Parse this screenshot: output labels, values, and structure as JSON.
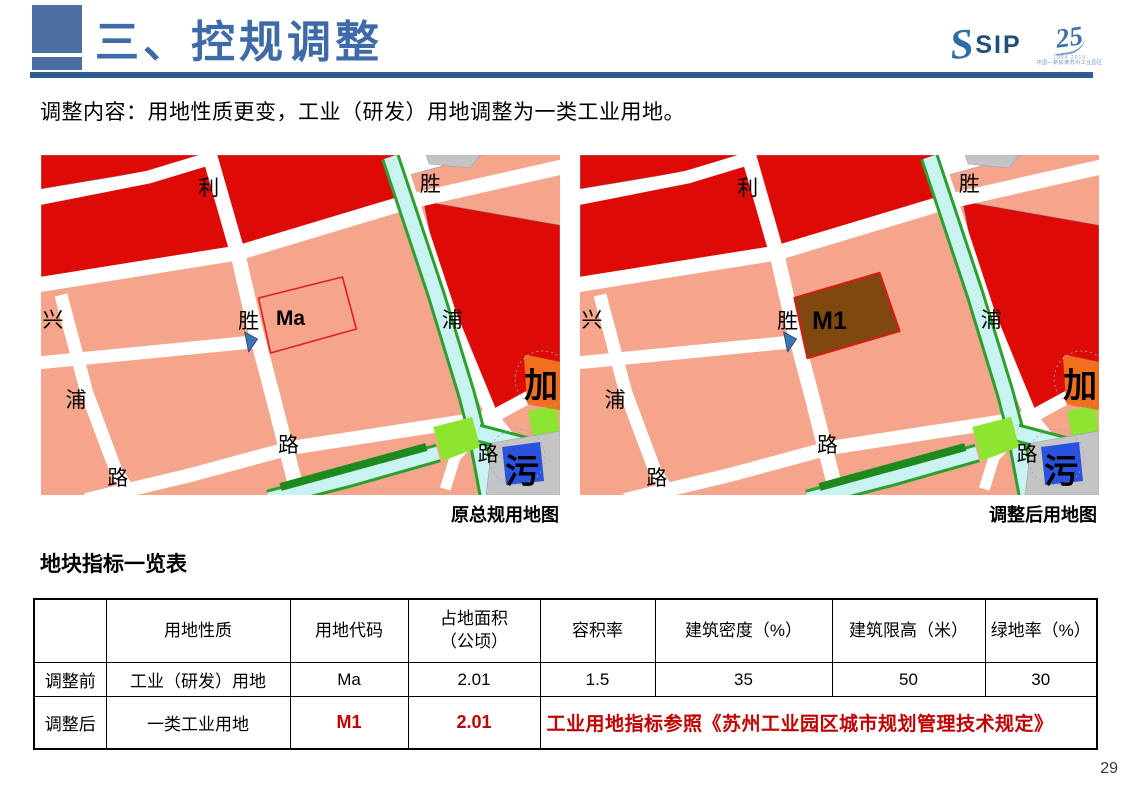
{
  "header": {
    "title": "三、控规调整"
  },
  "logo": {
    "sip": "SIP",
    "anniversary": "25",
    "years": "1994-2019",
    "tagline": "中国—新加坡苏州工业园区"
  },
  "subtitle": "调整内容：用地性质更变，工业（研发）用地调整为一类工业用地。",
  "maps": {
    "left": {
      "caption": "原总规用地图",
      "parcel_code": "Ma",
      "labels": [
        "利",
        "胜",
        "兴",
        "胜",
        "浦",
        "浦",
        "路",
        "路",
        "路",
        "加",
        "污"
      ]
    },
    "right": {
      "caption": "调整后用地图",
      "parcel_code": "M1",
      "labels": [
        "利",
        "胜",
        "兴",
        "胜",
        "浦",
        "浦",
        "路",
        "路",
        "路",
        "加",
        "污"
      ]
    }
  },
  "table": {
    "title": "地块指标一览表",
    "headers": [
      "",
      "用地性质",
      "用地代码",
      "占地面积\n（公顷）",
      "容积率",
      "建筑密度（%）",
      "建筑限高（米）",
      "绿地率（%）"
    ],
    "rows": [
      {
        "label": "调整前",
        "cells": [
          "工业（研发）用地",
          "Ma",
          "2.01",
          "1.5",
          "35",
          "50",
          "30"
        ],
        "highlight": false
      },
      {
        "label": "调整后",
        "cells": [
          "一类工业用地",
          "M1",
          "2.01"
        ],
        "highlight": true,
        "merged_note": "工业用地指标参照《苏州工业园区城市规划管理技术规定》"
      }
    ]
  },
  "page_number": "29",
  "colors": {
    "accent_blue": "#4A6FA0",
    "title_blue": "#3E6BA8",
    "rule_blue": "#2E5C90",
    "red_text": "#C00000",
    "map_dark_red": "#DD0A06",
    "map_salmon": "#F4A58B",
    "map_canal_cyan": "#C9F3F1",
    "map_green": "#2CA02C",
    "map_dark_green": "#1E8A1E",
    "map_bright_green": "#8DE431",
    "map_brown": "#7E480F",
    "map_blue_parcel": "#2A52DE",
    "map_gray": "#C4C4C4",
    "map_orange": "#F07020",
    "parcel_outline_red": "#E02020",
    "parcel_fill_border": "#CC2211",
    "arrow_blue": "#3F74B5"
  }
}
